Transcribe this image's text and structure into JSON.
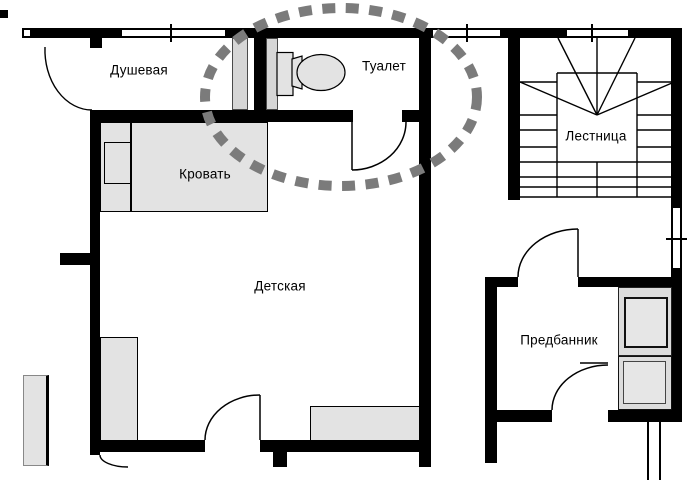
{
  "rooms": [
    {
      "id": "shower",
      "label": "Душевая"
    },
    {
      "id": "toilet",
      "label": "Туалет"
    },
    {
      "id": "bed",
      "label": "Кровать"
    },
    {
      "id": "nursery",
      "label": "Детская"
    },
    {
      "id": "staircase",
      "label": "Лестница"
    },
    {
      "id": "anteroom",
      "label": "Предбанник"
    }
  ],
  "colors": {
    "wall": "#000000",
    "furniture": "#e3e3e3",
    "duct": "#d6d6d6",
    "highlight": "#7b7b7b"
  }
}
